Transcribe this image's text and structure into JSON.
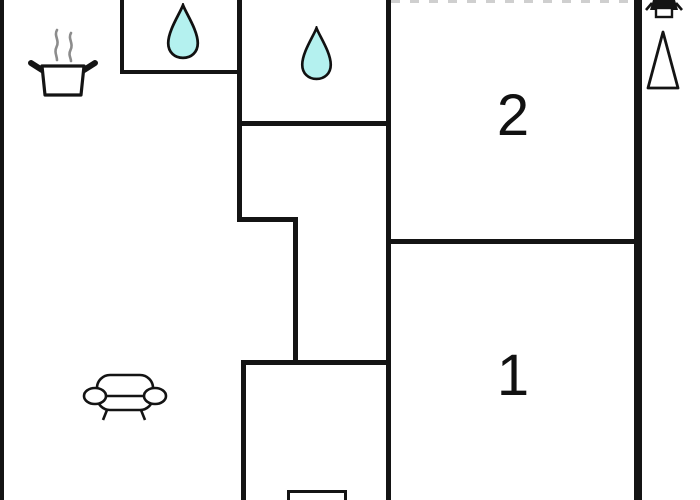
{
  "floorplan": {
    "rooms": {
      "room2": {
        "label": "2"
      },
      "room1": {
        "label": "1"
      }
    },
    "icons": {
      "water_drop_top_left": "water-drop",
      "water_drop_top_middle": "water-drop",
      "cooking_pot": "cooking-pot-with-steam",
      "sofa": "sofa",
      "north_arrow": "north-arrow-triangle",
      "wall_lamp": "wall-lamp",
      "bottom_fixture": "fixture-partially-cropped"
    },
    "colors": {
      "wall": "#141414",
      "water_drop_fill": "#b4f1ef",
      "water_drop_stroke": "#111111",
      "steam": "#8c8c8c",
      "background": "#ffffff"
    }
  }
}
